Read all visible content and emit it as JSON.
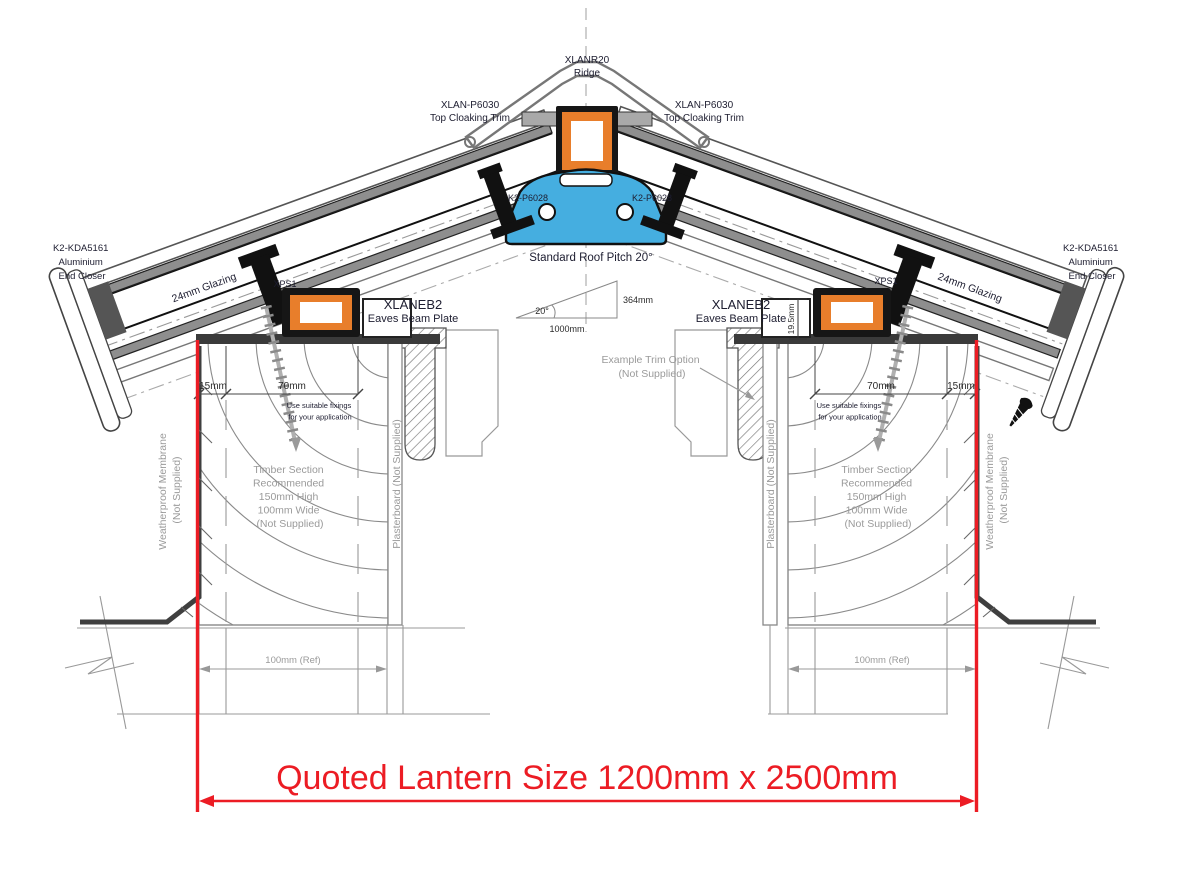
{
  "drawing": {
    "ridge": {
      "code": "XLANR20",
      "name": "Ridge"
    },
    "cloak_left": {
      "code": "XLAN-P6030",
      "name": "Top Cloaking Trim"
    },
    "cloak_right": {
      "code": "XLAN-P6030",
      "name": "Top Cloaking Trim"
    },
    "bolt_left": "K2-P6028",
    "bolt_right": "K2-P6028",
    "closer_left": {
      "l1": "K2-KDA5161",
      "l2": "Aluminium",
      "l3": "End Closer"
    },
    "closer_right": {
      "l1": "K2-KDA5161",
      "l2": "Aluminium",
      "l3": "End Closer"
    },
    "glazing_left": "24mm Glazing",
    "glazing_right": "24mm Glazing",
    "pitch": {
      "note": "Standard Roof Pitch 20°",
      "angle": "20°",
      "rise": "364mm",
      "run": "1000mm"
    },
    "xps_left": "XPS1",
    "xps_right": "XPS1",
    "eaves_left": {
      "code": "XLANEB2",
      "name": "Eaves Beam Plate"
    },
    "eaves_right": {
      "code": "XLANEB2",
      "name": "Eaves Beam Plate"
    },
    "beam_height": "19.5mm",
    "dim_left": {
      "edge": "15mm",
      "fix": "70mm"
    },
    "dim_right": {
      "edge": "15mm",
      "fix": "70mm"
    },
    "fix_note_left": {
      "l1": "Use suitable fixings",
      "l2": "for your application"
    },
    "fix_note_right": {
      "l1": "Use suitable fixings",
      "l2": "for your application"
    },
    "timber_left": {
      "l1": "Timber Section",
      "l2": "Recommended",
      "l3": "150mm High",
      "l4": "100mm Wide",
      "l5": "(Not Supplied)"
    },
    "timber_right": {
      "l1": "Timber Section",
      "l2": "Recommended",
      "l3": "150mm High",
      "l4": "100mm Wide",
      "l5": "(Not Supplied)"
    },
    "membrane_left": {
      "l1": "Weatherproof Membrane",
      "l2": "(Not Supplied)"
    },
    "membrane_right": {
      "l1": "Weatherproof Membrane",
      "l2": "(Not Supplied)"
    },
    "board_left": "Plasterboard (Not Supplied)",
    "board_right": "Plasterboard (Not Supplied)",
    "trim_note": {
      "l1": "Example Trim Option",
      "l2": "(Not Supplied)"
    },
    "wall_left": "100mm (Ref)",
    "wall_right": "100mm (Ref)",
    "quoted": "Quoted Lantern Size 1200mm x 2500mm",
    "colors": {
      "accent_red": "#EC1C24",
      "profile_orange": "#E87E2B",
      "profile_blue": "#45AEE0",
      "steel_grey": "#8E8E8E",
      "ink": "#161616",
      "note_grey": "#9A9A9A"
    }
  }
}
